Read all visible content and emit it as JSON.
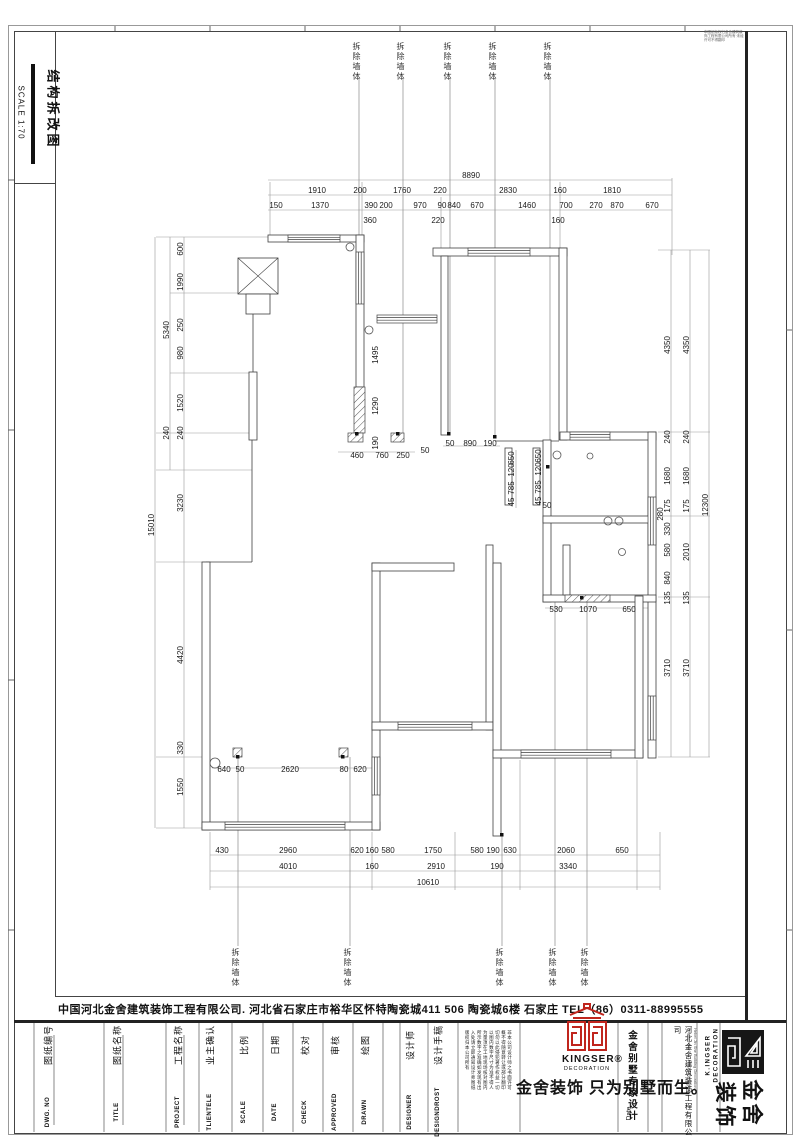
{
  "sheet": {
    "title": "结构拆改图",
    "scale_label": "SCALE 1:70",
    "corner_note": "本图纸版权归金舍建筑装饰工程有限公司所有·未经许可不得翻印",
    "company_line": "中国河北金舍建筑装饰工程有限公司. 河北省石家庄市裕华区怀特陶瓷城411 506 陶瓷城6楼    石家庄    TEL（86）0311-88995555"
  },
  "plan": {
    "demolish": {
      "label": "拆除墙体",
      "top_x": [
        356,
        400,
        447,
        492,
        547
      ],
      "top_y": 42,
      "bottom_x": [
        235,
        347,
        499,
        552,
        584
      ],
      "bottom_y": 948
    },
    "dimensions": {
      "top": [
        [
          "8890",
          471,
          176,
          0
        ],
        [
          "1910",
          317,
          191,
          0
        ],
        [
          "200",
          360,
          191,
          0
        ],
        [
          "1760",
          402,
          191,
          0
        ],
        [
          "220",
          440,
          191,
          0
        ],
        [
          "2830",
          508,
          191,
          0
        ],
        [
          "160",
          560,
          191,
          0
        ],
        [
          "1810",
          612,
          191,
          0
        ],
        [
          "150",
          276,
          206,
          0
        ],
        [
          "1370",
          320,
          206,
          0
        ],
        [
          "390",
          371,
          206,
          0
        ],
        [
          "200",
          386,
          206,
          0
        ],
        [
          "970",
          420,
          206,
          0
        ],
        [
          "90",
          442,
          206,
          0
        ],
        [
          "840",
          454,
          206,
          0
        ],
        [
          "670",
          477,
          206,
          0
        ],
        [
          "1460",
          527,
          206,
          0
        ],
        [
          "700",
          566,
          206,
          0
        ],
        [
          "270",
          596,
          206,
          0
        ],
        [
          "870",
          617,
          206,
          0
        ],
        [
          "670",
          652,
          206,
          0
        ],
        [
          "360",
          370,
          221,
          0
        ],
        [
          "220",
          438,
          221,
          0
        ],
        [
          "160",
          558,
          221,
          0
        ]
      ],
      "left": [
        [
          "15010",
          152,
          525,
          -90
        ],
        [
          "5340",
          167,
          330,
          -90
        ],
        [
          "600",
          181,
          249,
          -90
        ],
        [
          "1990",
          181,
          282,
          -90
        ],
        [
          "250",
          181,
          325,
          -90
        ],
        [
          "980",
          181,
          353,
          -90
        ],
        [
          "1520",
          181,
          403,
          -90
        ],
        [
          "240",
          167,
          433,
          -90
        ],
        [
          "240",
          181,
          433,
          -90
        ],
        [
          "3230",
          181,
          503,
          -90
        ],
        [
          "4420",
          181,
          655,
          -90
        ],
        [
          "330",
          181,
          748,
          -90
        ],
        [
          "1550",
          181,
          787,
          -90
        ]
      ],
      "right": [
        [
          "12300",
          706,
          505,
          -90
        ],
        [
          "4350",
          668,
          345,
          -90
        ],
        [
          "4350",
          687,
          345,
          -90
        ],
        [
          "240",
          668,
          437,
          -90
        ],
        [
          "240",
          687,
          437,
          -90
        ],
        [
          "1680",
          668,
          476,
          -90
        ],
        [
          "1680",
          687,
          476,
          -90
        ],
        [
          "175",
          668,
          506,
          -90
        ],
        [
          "175",
          687,
          506,
          -90
        ],
        [
          "280",
          661,
          514,
          -90
        ],
        [
          "330",
          668,
          529,
          -90
        ],
        [
          "580",
          668,
          550,
          -90
        ],
        [
          "840",
          668,
          578,
          -90
        ],
        [
          "2010",
          687,
          552,
          -90
        ],
        [
          "135",
          668,
          598,
          -90
        ],
        [
          "135",
          687,
          598,
          -90
        ],
        [
          "3710",
          668,
          668,
          -90
        ],
        [
          "3710",
          687,
          668,
          -90
        ]
      ],
      "bottom": [
        [
          "430",
          222,
          851,
          0
        ],
        [
          "2960",
          288,
          851,
          0
        ],
        [
          "620",
          357,
          851,
          0
        ],
        [
          "160",
          372,
          851,
          0
        ],
        [
          "580",
          388,
          851,
          0
        ],
        [
          "1750",
          433,
          851,
          0
        ],
        [
          "580",
          477,
          851,
          0
        ],
        [
          "190",
          493,
          851,
          0
        ],
        [
          "630",
          510,
          851,
          0
        ],
        [
          "2060",
          566,
          851,
          0
        ],
        [
          "650",
          622,
          851,
          0
        ],
        [
          "4010",
          288,
          867,
          0
        ],
        [
          "160",
          372,
          867,
          0
        ],
        [
          "2910",
          436,
          867,
          0
        ],
        [
          "190",
          497,
          867,
          0
        ],
        [
          "3340",
          568,
          867,
          0
        ],
        [
          "10610",
          428,
          883,
          0
        ]
      ],
      "interior": [
        [
          "1495",
          376,
          355,
          -90
        ],
        [
          "1290",
          376,
          406,
          -90
        ],
        [
          "190",
          376,
          443,
          -90
        ],
        [
          "460",
          357,
          456,
          0
        ],
        [
          "760",
          382,
          456,
          0
        ],
        [
          "250",
          403,
          456,
          0
        ],
        [
          "50",
          450,
          444,
          0
        ],
        [
          "890",
          470,
          444,
          0
        ],
        [
          "190",
          490,
          444,
          0
        ],
        [
          "650",
          512,
          458,
          -90
        ],
        [
          "120",
          512,
          470,
          -90
        ],
        [
          "785",
          512,
          488,
          -90
        ],
        [
          "45",
          512,
          502,
          -90
        ],
        [
          "650",
          539,
          456,
          -90
        ],
        [
          "120",
          539,
          469,
          -90
        ],
        [
          "785",
          539,
          487,
          -90
        ],
        [
          "45",
          539,
          501,
          -90
        ],
        [
          "50",
          425,
          451,
          0
        ],
        [
          "50",
          547,
          506,
          0
        ],
        [
          "530",
          556,
          610,
          0
        ],
        [
          "1070",
          588,
          610,
          0
        ],
        [
          "650",
          629,
          610,
          0
        ],
        [
          "640",
          224,
          770,
          0
        ],
        [
          "50",
          240,
          770,
          0
        ],
        [
          "2620",
          290,
          770,
          0
        ],
        [
          "80",
          344,
          770,
          0
        ],
        [
          "620",
          360,
          770,
          0
        ]
      ]
    }
  },
  "title_block": {
    "fields": [
      {
        "cn": "图纸编号",
        "en": "DWG. NO",
        "x": 48
      },
      {
        "cn": "图纸名称",
        "en": "TITLE",
        "x": 117
      },
      {
        "cn": "工程名称",
        "en": "PROJECT",
        "x": 178
      },
      {
        "cn": "业主确认",
        "en": "TLIENTELE",
        "x": 210
      },
      {
        "cn": "比例",
        "en": "SCALE",
        "x": 244
      },
      {
        "cn": "日期",
        "en": "DATE",
        "x": 275
      },
      {
        "cn": "校对",
        "en": "CHECK",
        "x": 305
      },
      {
        "cn": "审核",
        "en": "APPROVED",
        "x": 335
      },
      {
        "cn": "绘图",
        "en": "DRAWN",
        "x": 365
      },
      {
        "cn": "设计师",
        "en": "DESIGNER",
        "x": 410
      },
      {
        "cn": "设计手稿",
        "en": "DESIGNDROST",
        "x": 438
      }
    ],
    "disclaimer_lines": [
      "非本公司设计师之书面许可",
      "概不得随意转让或部分翻印",
      "切勿以此侵犯著作权益一切",
      "以图内数字尺寸为准不得人",
      "为量须在工地现场核对图内",
      "所示数字之准确如发现有出",
      "入处请立即通知设计师图纸",
      "版权归本公司所有"
    ],
    "kingser_logo_word": "KINGSER®",
    "kingser_logo_sub": "DECORATION",
    "slogan": "金舍装饰 只为别墅而生。",
    "brand_column": "金舍别墅专家设计",
    "date_label": "Date",
    "hebei_company": "河北金舍建筑装饰工程有限公司",
    "hebei_company_en": "Hebei Jin She Building Decoration\nEngineering Co.,Ltd 石家庄市裕华区",
    "kingser_vertical_1": "K.INGSER",
    "kingser_vertical_2": "DECORATION",
    "logo_char_1": "金",
    "logo_char_2": "舍",
    "logo_char_3": "装",
    "logo_char_4": "饰",
    "accent_red": "#c0251d",
    "line_dark": "#3f3f3f"
  }
}
